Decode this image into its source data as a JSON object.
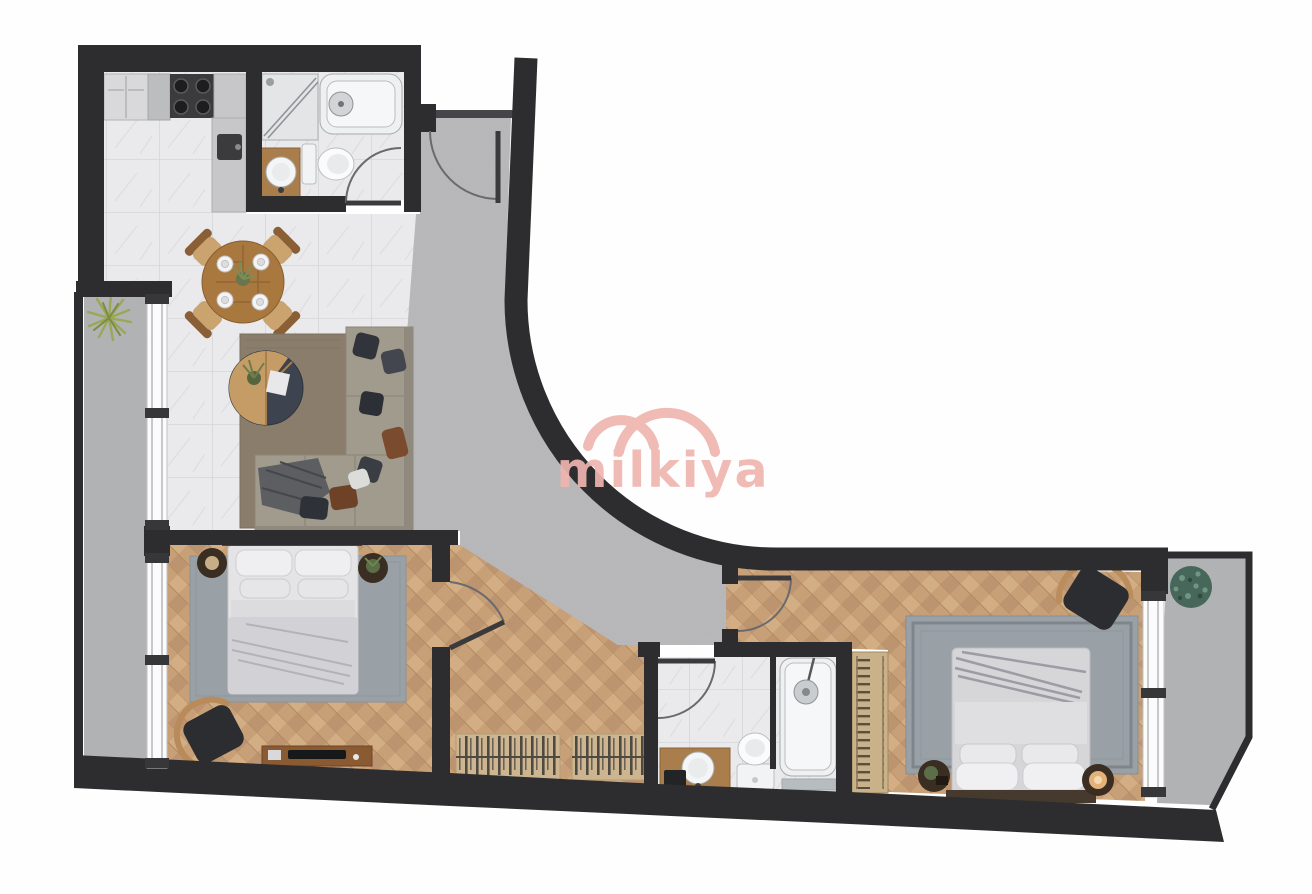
{
  "watermark": {
    "text": "milkiya",
    "color": "#efb5af"
  },
  "palette": {
    "wall": "#2d2d2f",
    "concrete_floor": "#b9babc",
    "marble_floor": "#eaeaec",
    "wood_floor": "#c8a077",
    "rug_gray": "#9aa1a7",
    "rug_living": "#8a7d6b",
    "sofa": "#a19b8e",
    "furniture_wood": "#a97d4c",
    "table_wood": "#a9783f",
    "fixture_white": "#f2f3f4",
    "wardrobe_tan": "#cdb590",
    "plant_green": "#6f8f4f",
    "plant_dark_green": "#47675a",
    "bedding": "#d6d6d9"
  },
  "plan": {
    "rooms": [
      {
        "id": "kitchen-living-room",
        "floor": "marble-tile"
      },
      {
        "id": "bathroom-1",
        "floor": "marble-tile"
      },
      {
        "id": "entry-hallway",
        "floor": "concrete"
      },
      {
        "id": "bedroom-1",
        "floor": "herringbone-parquet"
      },
      {
        "id": "corridor",
        "floor": "herringbone-parquet"
      },
      {
        "id": "bathroom-2",
        "floor": "marble-tile"
      },
      {
        "id": "bedroom-2",
        "floor": "herringbone-parquet"
      },
      {
        "id": "balcony-left",
        "floor": "concrete"
      },
      {
        "id": "balcony-right",
        "floor": "concrete"
      }
    ],
    "furniture": [
      {
        "name": "kitchen-counter-with-stove-and-fridge",
        "room": "kitchen-living-room"
      },
      {
        "name": "round-dining-table-4-chairs",
        "room": "kitchen-living-room"
      },
      {
        "name": "round-coffee-table",
        "room": "kitchen-living-room"
      },
      {
        "name": "l-shaped-sofa",
        "room": "kitchen-living-room"
      },
      {
        "name": "area-rug",
        "room": "kitchen-living-room"
      },
      {
        "name": "shower",
        "room": "bathroom-1"
      },
      {
        "name": "bathtub",
        "room": "bathroom-1"
      },
      {
        "name": "toilet",
        "room": "bathroom-1"
      },
      {
        "name": "vanity-sink",
        "room": "bathroom-1"
      },
      {
        "name": "double-bed",
        "room": "bedroom-1"
      },
      {
        "name": "nightstands",
        "room": "bedroom-1"
      },
      {
        "name": "armchair",
        "room": "bedroom-1"
      },
      {
        "name": "tv-console",
        "room": "bedroom-1"
      },
      {
        "name": "area-rug",
        "room": "bedroom-1"
      },
      {
        "name": "built-in-wardrobes",
        "room": "corridor"
      },
      {
        "name": "bathtub-with-shower",
        "room": "bathroom-2"
      },
      {
        "name": "toilet",
        "room": "bathroom-2"
      },
      {
        "name": "vanity-sink",
        "room": "bathroom-2"
      },
      {
        "name": "built-in-wardrobe",
        "room": "bedroom-2"
      },
      {
        "name": "double-bed",
        "room": "bedroom-2"
      },
      {
        "name": "nightstands",
        "room": "bedroom-2"
      },
      {
        "name": "armchair",
        "room": "bedroom-2"
      },
      {
        "name": "area-rug",
        "room": "bedroom-2"
      },
      {
        "name": "potted-plant",
        "room": "balcony-left"
      },
      {
        "name": "potted-plant",
        "room": "balcony-right"
      }
    ],
    "doors": [
      {
        "name": "entry-door",
        "between": [
          "exterior",
          "entry-hallway"
        ]
      },
      {
        "name": "bathroom-1-door",
        "between": [
          "kitchen-living-room",
          "bathroom-1"
        ]
      },
      {
        "name": "bedroom-1-door",
        "between": [
          "corridor",
          "bedroom-1"
        ]
      },
      {
        "name": "bedroom-2-door",
        "between": [
          "entry-hallway",
          "bedroom-2"
        ]
      },
      {
        "name": "bathroom-2-door",
        "between": [
          "entry-hallway",
          "bathroom-2"
        ]
      }
    ],
    "windows": [
      {
        "name": "living-room-window",
        "side": "left-balcony"
      },
      {
        "name": "bedroom-1-window",
        "side": "left-balcony"
      },
      {
        "name": "bedroom-2-window",
        "side": "right-balcony"
      }
    ]
  }
}
